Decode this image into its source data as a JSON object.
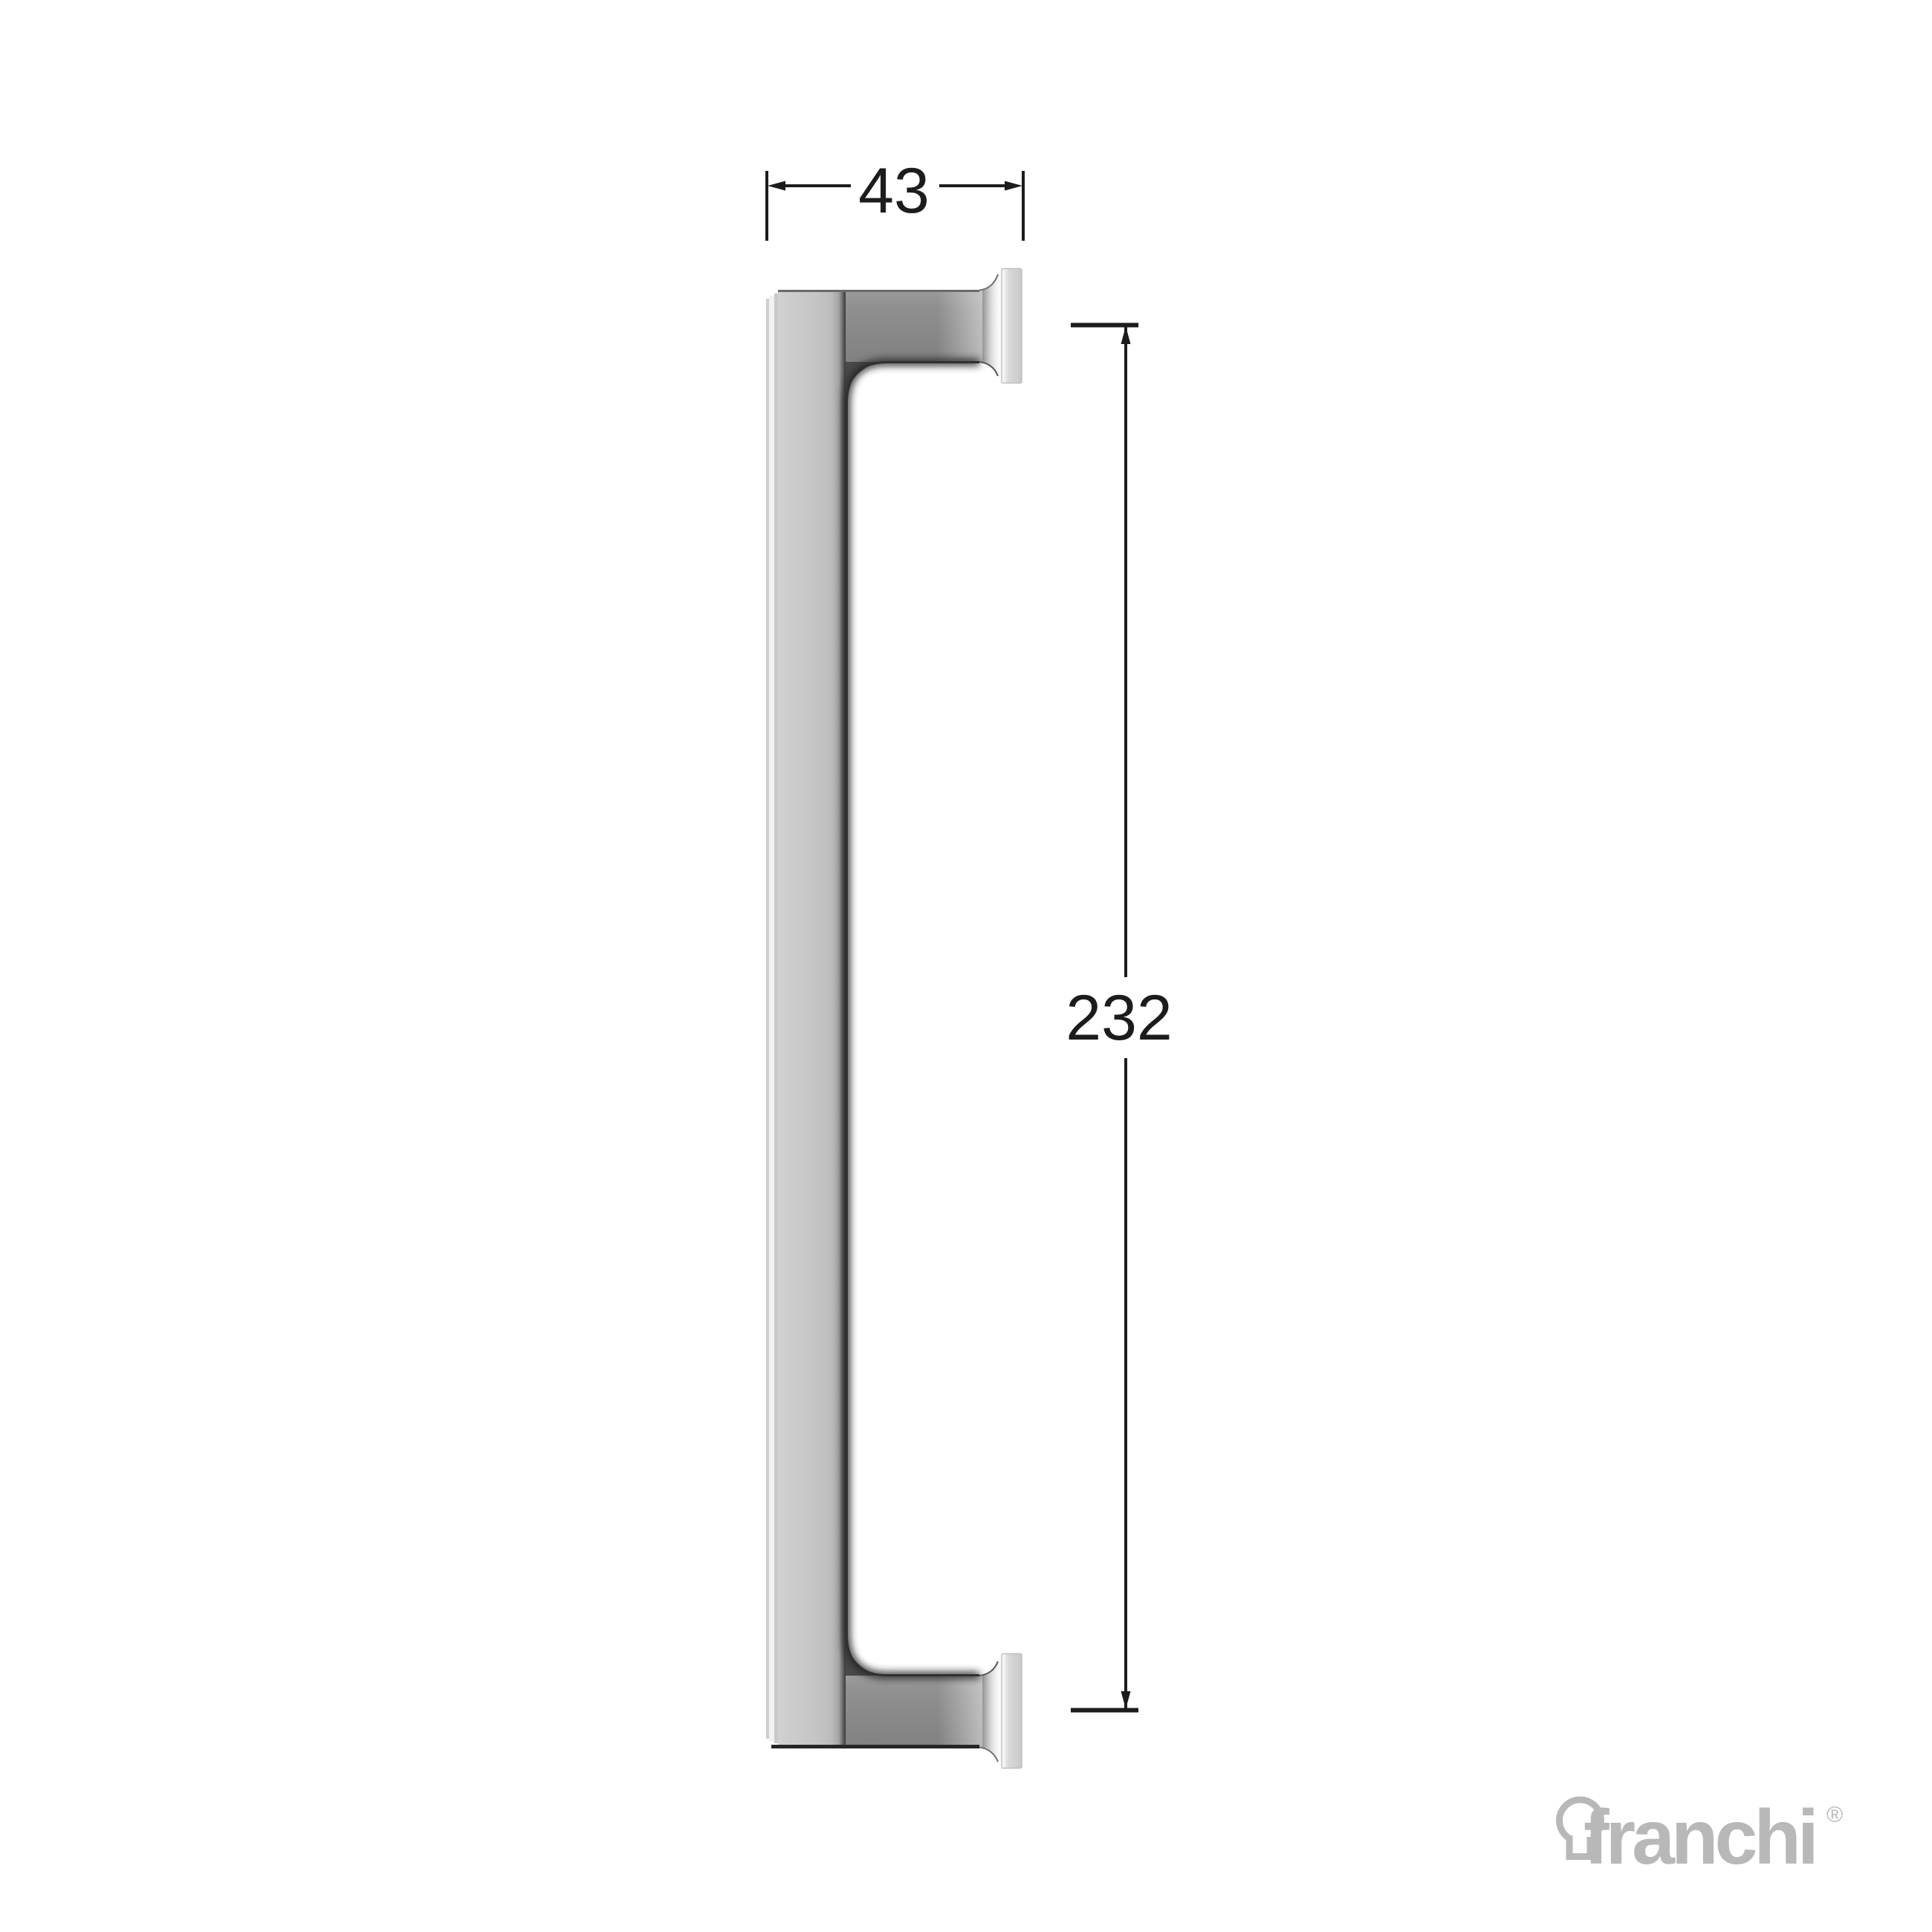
{
  "drawing": {
    "type": "technical-dimension-drawing",
    "part": "pull-handle-side-profile",
    "line_color": "#1c1c1c",
    "dimensions": {
      "width": {
        "value": "43"
      },
      "height": {
        "value": "232"
      }
    }
  },
  "handle_colors": {
    "grip_face_light": "#cecece",
    "grip_face_mid": "#c4c4c4",
    "post_grey": "#8d8d8d",
    "flange_grey": "#d4d4d4",
    "inner_shadow": "#2e2e2e"
  },
  "branding": {
    "logo_text": "franchi",
    "registered_mark": "®",
    "logo_color": "#b8b8b8",
    "logo_icon": "keyhole-icon"
  }
}
